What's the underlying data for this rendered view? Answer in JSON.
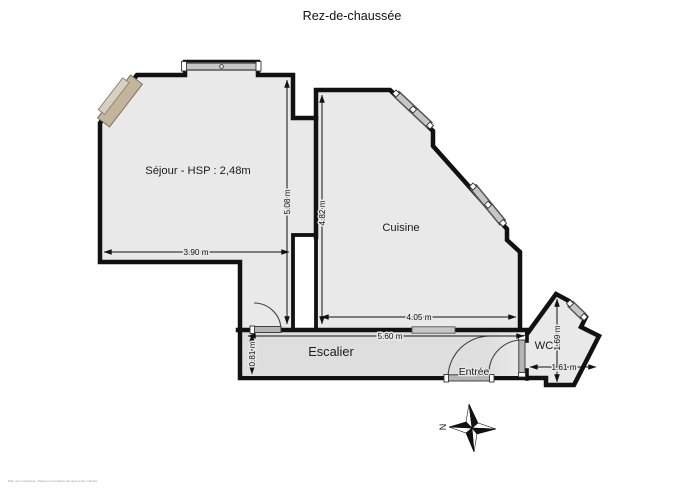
{
  "title": "Rez-de-chaussée",
  "rooms": {
    "sejour": {
      "label": "Séjour - HSP : 2,48m"
    },
    "cuisine": {
      "label": "Cuisine"
    },
    "escalier": {
      "label": "Escalier"
    },
    "entree": {
      "label": "Entrée"
    },
    "wc": {
      "label": "WC"
    }
  },
  "dimensions": {
    "sejour_width": "3.90 m",
    "sejour_height": "5.08 m",
    "cuisine_height": "4.82 m",
    "cuisine_width": "4.05 m",
    "hall_length": "5.60 m",
    "hall_width": "0.81 m",
    "wc_height": "1.69 m",
    "wc_width": "1.61 m"
  },
  "compass": {
    "north": "N"
  },
  "fine_print": "Plan non contractuel - Mesures et surfaces données à titre indicatif",
  "colors": {
    "wall": "#111111",
    "floor": "#e9e9e9",
    "stair_shade": "#dedede",
    "window": "#c6c6c6",
    "fireplace": "#c3b49c"
  }
}
